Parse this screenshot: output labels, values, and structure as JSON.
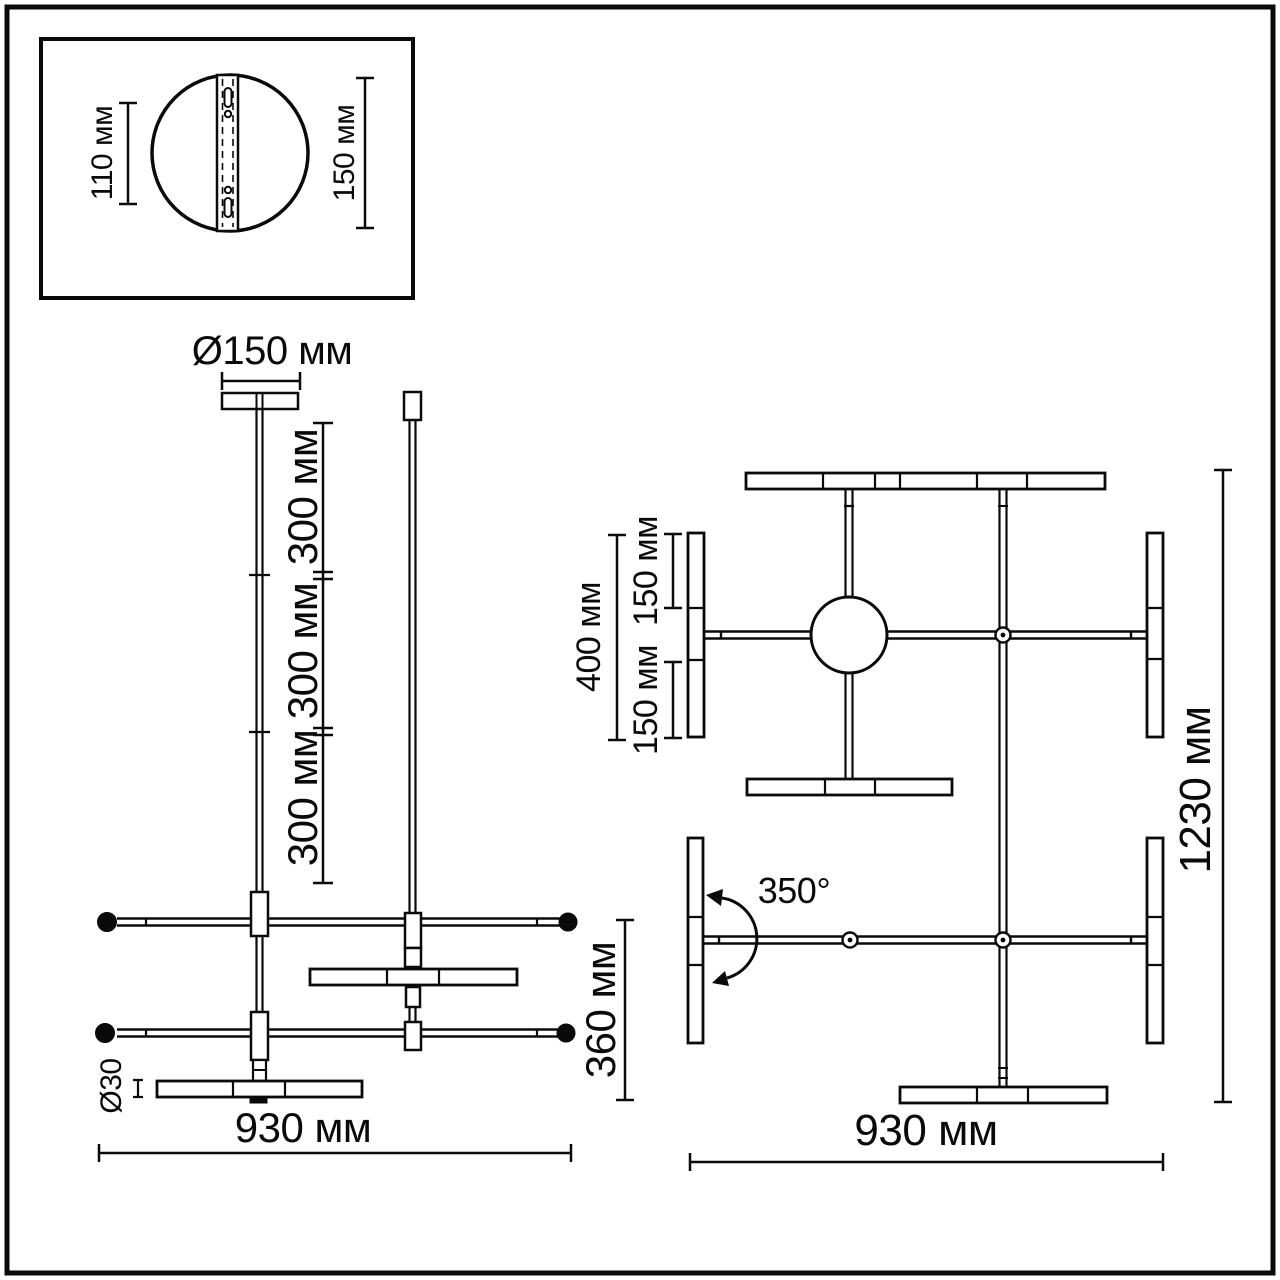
{
  "detail_box": {
    "dim_height": "110 мм",
    "dim_width": "150 мм"
  },
  "front_view": {
    "canopy_diameter": "Ø150 мм",
    "rod_section_1": "300 мм",
    "rod_section_2": "300 мм",
    "rod_section_3": "300 мм",
    "rod_diameter": "Ø30",
    "total_width": "930 мм",
    "body_height": "360 мм"
  },
  "top_view": {
    "tube_length": "400 мм",
    "tube_half_top": "150 мм",
    "tube_half_bottom": "150 мм",
    "rotation_angle": "350°",
    "total_length": "1230 мм",
    "total_width": "930 мм"
  }
}
